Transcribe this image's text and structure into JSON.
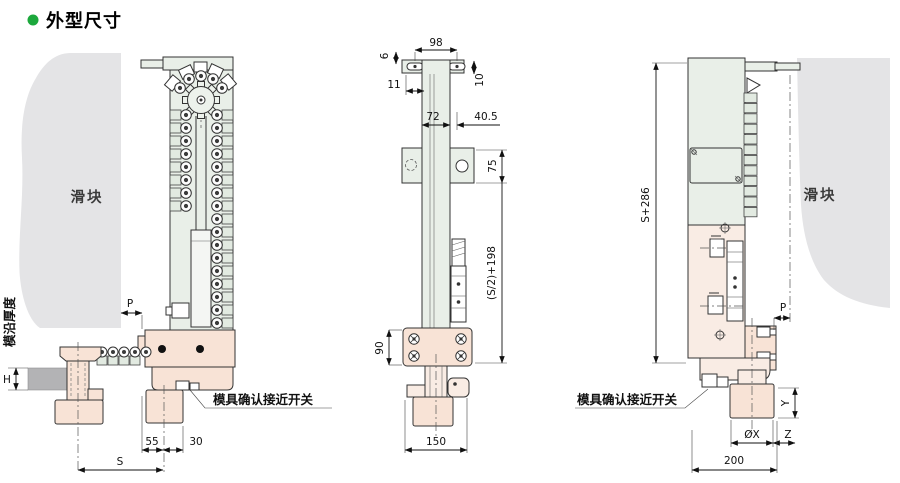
{
  "header": {
    "title": "外型尺寸"
  },
  "labels": {
    "slide_left": "滑块",
    "slide_right": "滑块",
    "switch_left": "模具确认接近开关",
    "switch_right": "模具确认接近开关",
    "edge_thickness": "模沿厚度"
  },
  "dims": {
    "left": {
      "p": "P",
      "h": "H",
      "d55": "55",
      "d30": "30",
      "s": "S"
    },
    "middle": {
      "d98": "98",
      "d6": "6",
      "d10": "10",
      "d11": "11",
      "d72": "72",
      "d40_5": "40.5",
      "d75": "75",
      "s2": "(S/2)+198",
      "d90": "90",
      "d150": "150"
    },
    "right": {
      "s286": "S+286",
      "p": "P",
      "y": "Y",
      "ox": "ØX",
      "z": "Z",
      "d200": "200"
    }
  },
  "colors": {
    "accent_green": "#1ca83c",
    "fill_green": "#e9efe8",
    "fill_pink": "#f8e3d6",
    "fill_gray": "#e4e4e6",
    "fill_dark_gray": "#b3b3b5",
    "line": "#333333"
  }
}
